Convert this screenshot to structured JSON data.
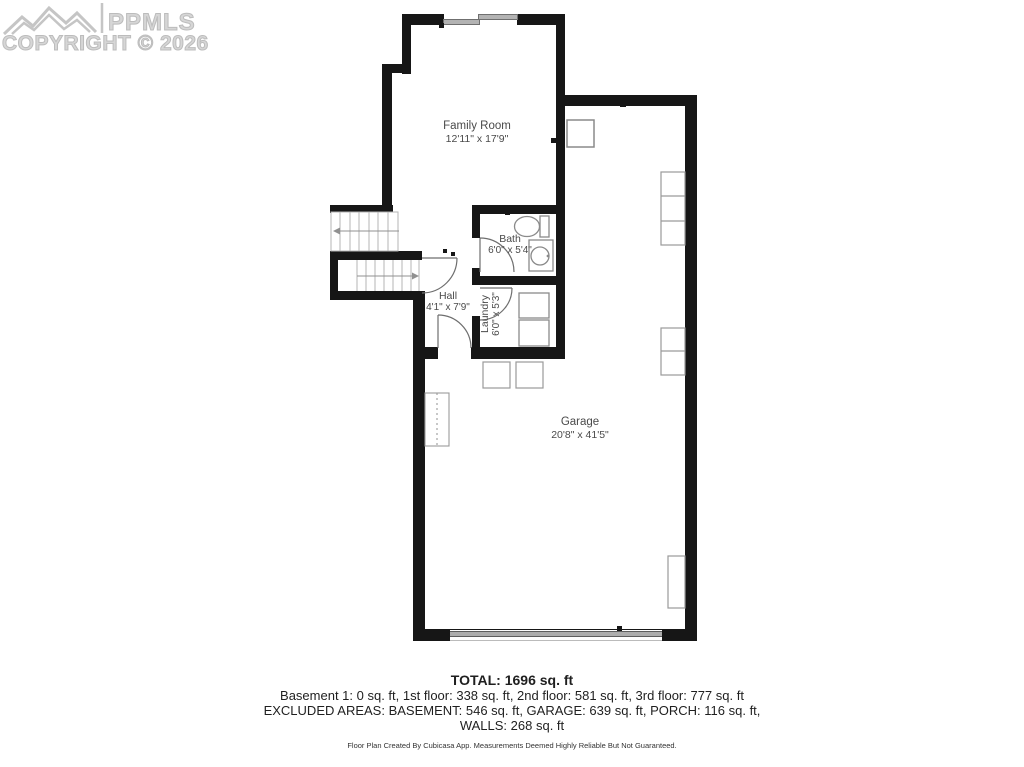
{
  "watermark": {
    "brand": "PPMLS",
    "copyright": "COPYRIGHT © 2026"
  },
  "rooms": [
    {
      "id": "family-room",
      "name": "Family Room",
      "dims": "12'11\" x 17'9\""
    },
    {
      "id": "bath",
      "name": "Bath",
      "dims": "6'0\" x 5'4\""
    },
    {
      "id": "hall",
      "name": "Hall",
      "dims": "4'1\" x 7'9\""
    },
    {
      "id": "laundry",
      "name": "Laundry",
      "dims": "6'0\" x 5'3\""
    },
    {
      "id": "garage",
      "name": "Garage",
      "dims": "20'8\" x 41'5\""
    }
  ],
  "summary": {
    "total": "TOTAL: 1696 sq. ft",
    "floors": "Basement 1: 0 sq. ft, 1st floor: 338 sq. ft, 2nd floor: 581 sq. ft, 3rd floor: 777 sq. ft",
    "excluded": "EXCLUDED AREAS: BASEMENT: 546 sq. ft, GARAGE: 639 sq. ft, PORCH: 116 sq. ft,",
    "walls": "WALLS: 268 sq. ft",
    "disclaimer": "Floor Plan Created By Cubicasa App. Measurements Deemed Highly Reliable But Not Guaranteed."
  }
}
